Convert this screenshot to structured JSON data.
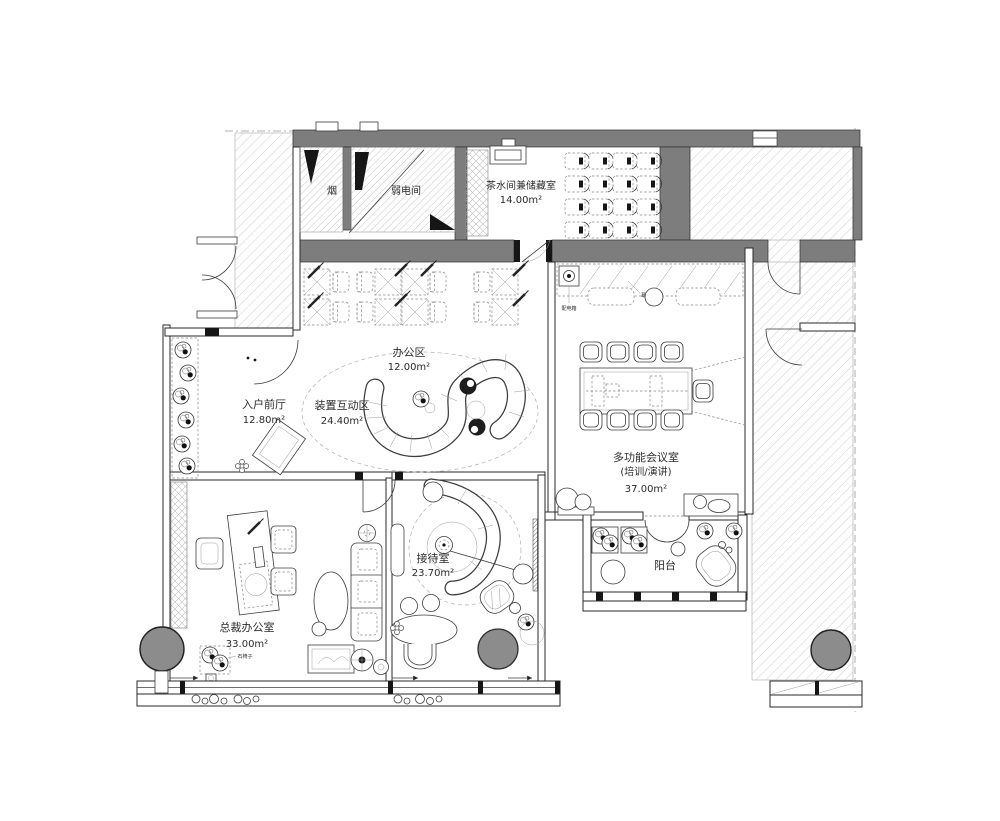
{
  "colors": {
    "wall_fill": "#7d7d7d",
    "column_fill": "#8c8c8c",
    "hatch_line": "#cfcfcf",
    "furniture_line": "#3c3c3c"
  },
  "rooms": {
    "smoke": {
      "label": "烟"
    },
    "low_voltage": {
      "label": "弱电间"
    },
    "pantry": {
      "label": "茶水间兼储藏室",
      "area": "14.00m²"
    },
    "office": {
      "label": "办公区",
      "area": "12.00m²"
    },
    "foyer": {
      "label": "入户前厅",
      "area": "12.80m²"
    },
    "installation": {
      "label": "装置互动区",
      "area": "24.40m²"
    },
    "meeting": {
      "label": "多功能会议室",
      "sub": "(培训/演讲)",
      "area": "37.00m²"
    },
    "reception": {
      "label": "接待室",
      "area": "23.70m²"
    },
    "balcony": {
      "label": "阳台"
    },
    "ceo": {
      "label": "总裁办公室",
      "area": "33.00m²"
    }
  },
  "annotations": {
    "stone_chair": "石椅子",
    "power_box": "配电箱",
    "screen": "幕布"
  }
}
